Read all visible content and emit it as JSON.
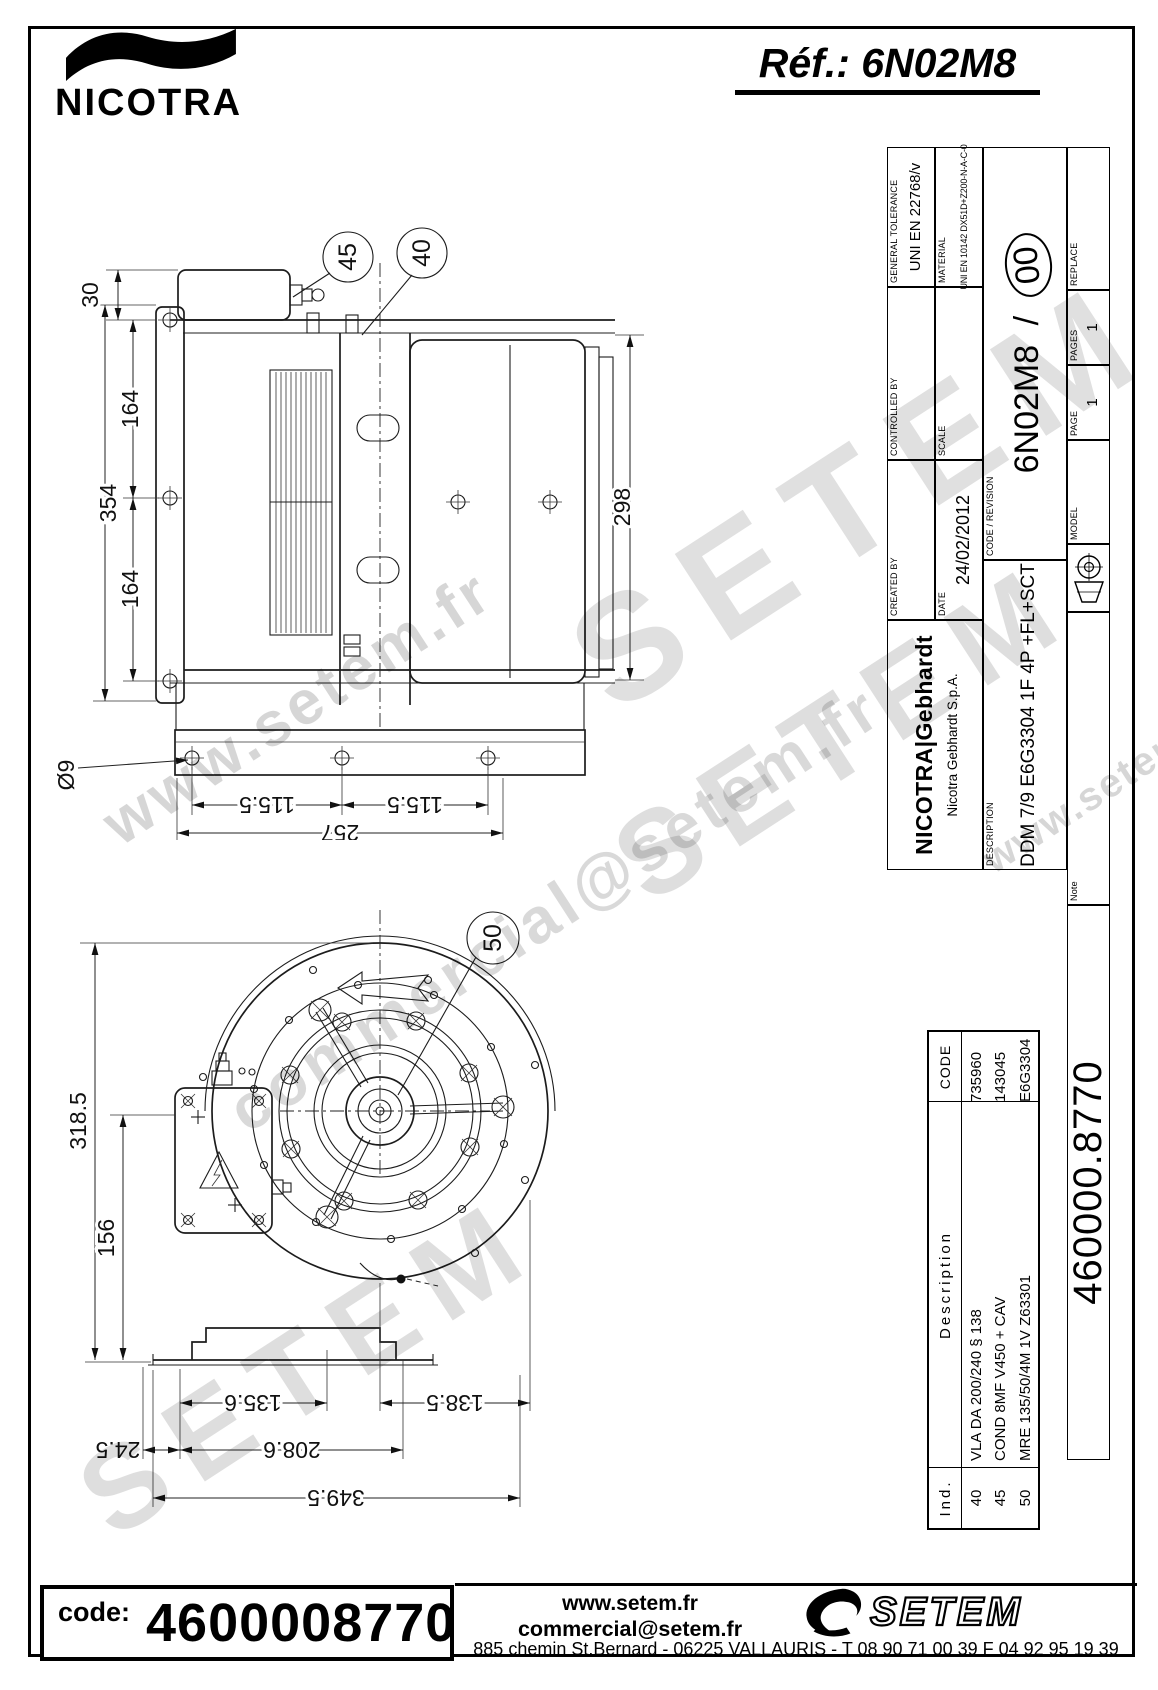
{
  "header": {
    "brand": "NICOTRA",
    "ref": "Réf.: 6N02M8"
  },
  "title_block": {
    "company": {
      "name": "NICOTRA|Gebhardt",
      "subtitle": "Nicotra Gebhardt S.p.A."
    },
    "general_tolerance": {
      "label": "GENERAL TOLERANCE",
      "value": "UNI EN 22768/v"
    },
    "material": {
      "label": "MATERIAL",
      "value": "UNI EN 10142 DX51D+Z200-N-A-C-0"
    },
    "controlled_by": {
      "label": "CONTROLLED BY",
      "value": ""
    },
    "created_by": {
      "label": "CREATED BY",
      "value": ""
    },
    "scale": {
      "label": "SCALE",
      "value": ""
    },
    "date": {
      "label": "DATE",
      "value": "24/02/2012"
    },
    "code_revision": {
      "label": "CODE / REVISION",
      "code": "6N02M8",
      "sep": "/",
      "revision": "00"
    },
    "description": {
      "label": "DESCRIPTION",
      "value": "DDM 7/9 E6G3304 1F 4P +FL+SCT"
    },
    "replace": {
      "label": "REPLACE",
      "value": ""
    },
    "pages": {
      "label": "PAGES",
      "value": "1"
    },
    "page": {
      "label": "PAGE",
      "value": "1"
    },
    "model": {
      "label": "MODEL",
      "value": ""
    },
    "note": {
      "label": "Note"
    },
    "doc_number": "460000.8770"
  },
  "parts_table": {
    "headers": {
      "ind": "Ind.",
      "description": "Description",
      "code": "CODE"
    },
    "rows": [
      {
        "ind": "40",
        "description": "VLA DA 200/240  § 138",
        "code": "735960"
      },
      {
        "ind": "45",
        "description": "COND 8MF V450 + CAV",
        "code": "143045"
      },
      {
        "ind": "50",
        "description": "MRE 135/50/4M 1V Z63301",
        "code": "E6G3304"
      }
    ]
  },
  "drawing_side_view": {
    "callouts": [
      "45",
      "40"
    ],
    "dims": {
      "top": "30",
      "left_total": "354",
      "left_upper": "164",
      "left_lower": "164",
      "right": "298",
      "bottom_left": "115.5",
      "bottom_right": "115.5",
      "bottom_total": "257",
      "hole": "Ø9"
    }
  },
  "drawing_front_view": {
    "callouts": [
      "50"
    ],
    "dims": {
      "left_total": "318.5",
      "left_inner": "156",
      "bottom_left": "135.6",
      "bottom_right": "138.5",
      "bottom_mid": "208.6",
      "bottom_offset": "24.5",
      "bottom_total": "349.5"
    }
  },
  "footer": {
    "code_label": "code:",
    "code_value": "4600008770",
    "website": "www.setem.fr",
    "email": "commercial@setem.fr",
    "address": "885 chemin St.Bernard  -  06225 VALLAURIS  -  T 08 90 71 00 39   F 04 92 95 19 39",
    "logo": "SETEM"
  },
  "watermarks": [
    "SETEM",
    "commercial@setem.fr",
    "www.setem.fr",
    "SETEM",
    "SETEM",
    "www.setem.fr"
  ]
}
